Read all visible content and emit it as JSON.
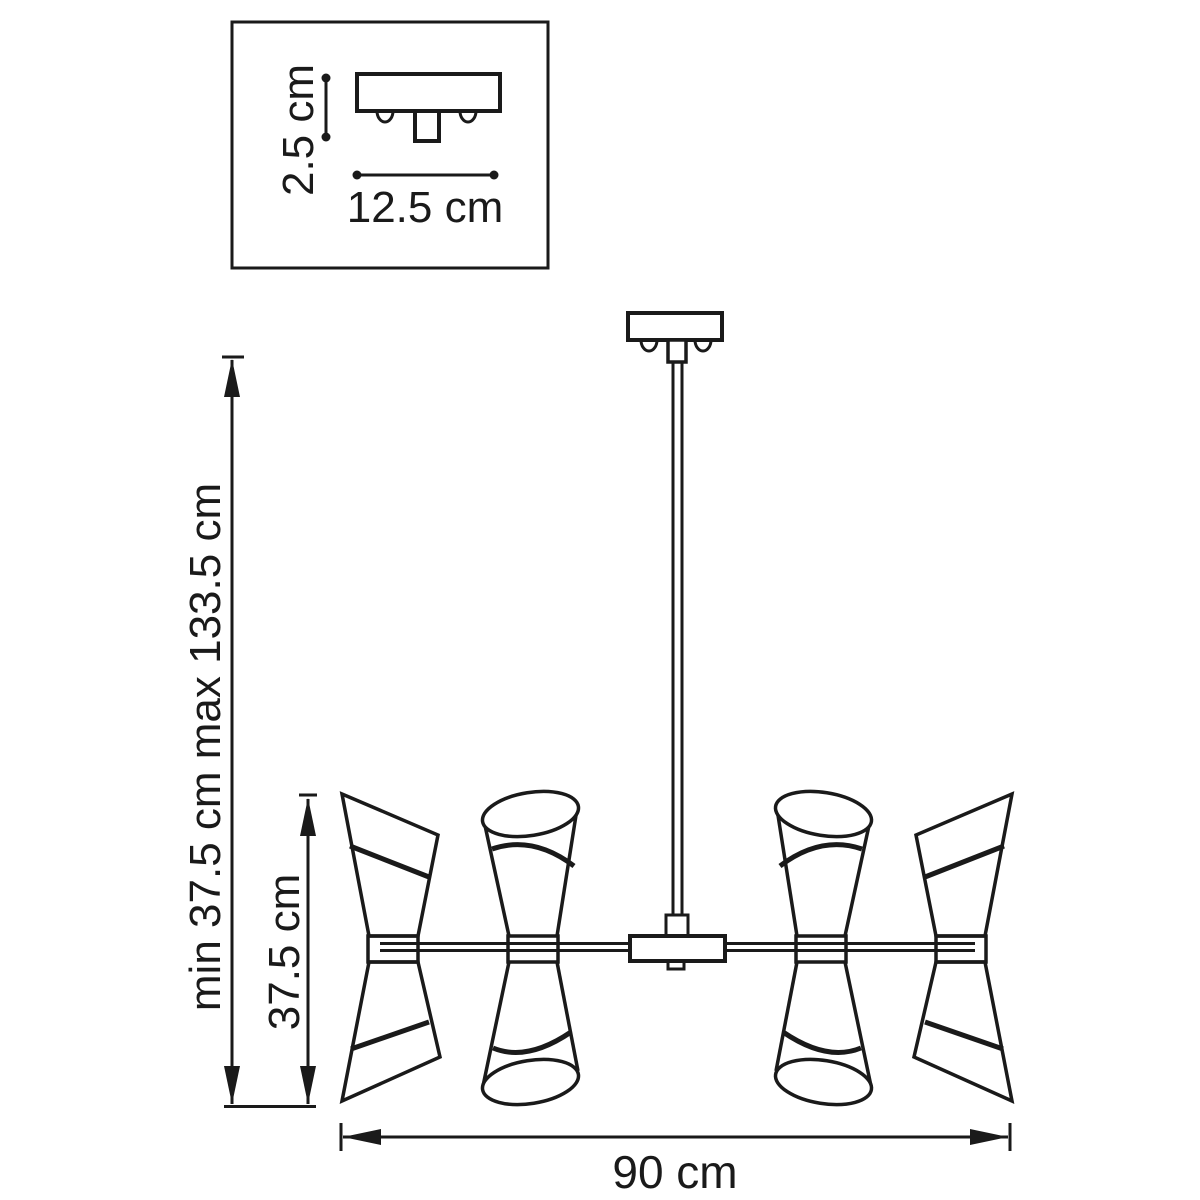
{
  "colors": {
    "line": "#1a1a1a",
    "background": "#ffffff"
  },
  "inset": {
    "height_label": "2.5 cm",
    "width_label": "12.5 cm"
  },
  "dimensions": {
    "hanging_height_label": "min 37.5 cm max 133.5 cm",
    "fixture_height_label": "37.5 cm",
    "fixture_width_label": "90 cm"
  }
}
